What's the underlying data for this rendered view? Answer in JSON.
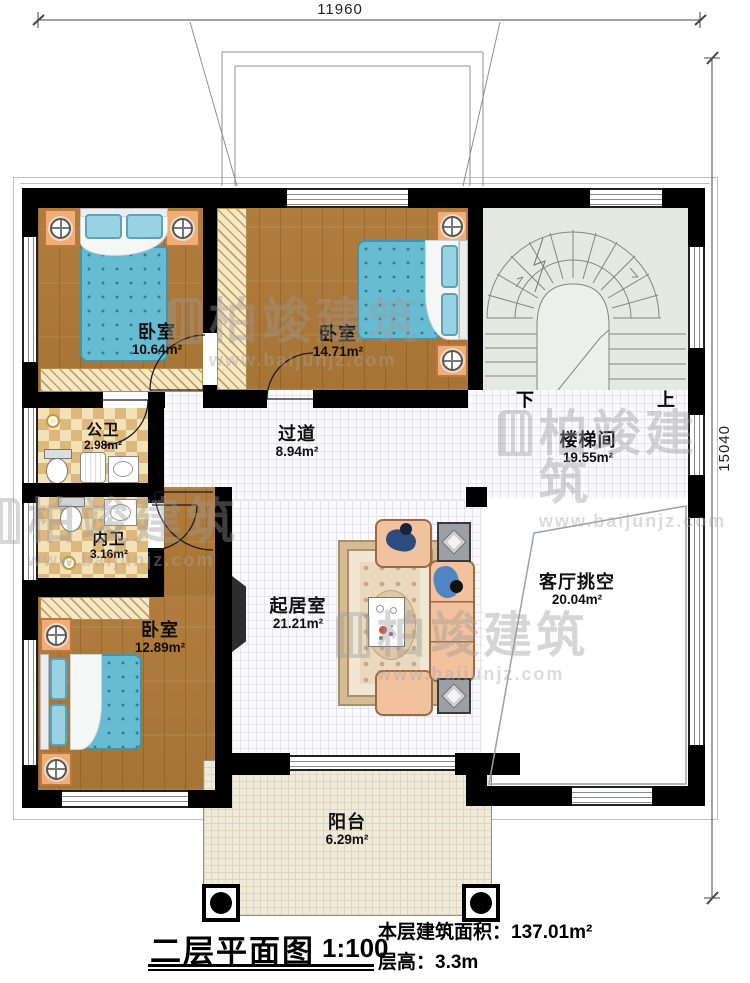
{
  "dimensions": {
    "top": "11960",
    "right": "15040"
  },
  "rooms": [
    {
      "id": "bedroom-top-left",
      "name": "卧室",
      "area": "10.64m²"
    },
    {
      "id": "bedroom-top-middle",
      "name": "卧室",
      "area": "14.71m²"
    },
    {
      "id": "stairwell",
      "name": "楼梯间",
      "area": "19.55m²"
    },
    {
      "id": "public-bath",
      "name": "公卫",
      "area": "2.98m²"
    },
    {
      "id": "corridor",
      "name": "过道",
      "area": "8.94m²"
    },
    {
      "id": "private-bath",
      "name": "内卫",
      "area": "3.16m²"
    },
    {
      "id": "bedroom-bottom-left",
      "name": "卧室",
      "area": "12.89m²"
    },
    {
      "id": "living-room",
      "name": "起居室",
      "area": "21.21m²"
    },
    {
      "id": "living-void",
      "name": "客厅挑空",
      "area": "20.04m²"
    },
    {
      "id": "balcony",
      "name": "阳台",
      "area": "6.29m²"
    }
  ],
  "stairs": {
    "down": "下",
    "up": "上"
  },
  "watermark": {
    "brand": "柏竣建筑",
    "url": "www.baijunjz.com"
  },
  "footer": {
    "title": "二层平面图",
    "scale": "1:100",
    "area_label": "本层建筑面积：",
    "area_value": "137.01m²",
    "height_label": "层高：",
    "height_value": "3.3m"
  },
  "colors": {
    "wall": "#000000",
    "wood_floor": "#ab7838",
    "bath_tile_light": "#f3e2b8",
    "bath_tile_dark": "#dcb87c",
    "stair_floor": "#e5e9e2",
    "balcony_floor": "#efeada",
    "bed_blanket": "#68bcd2",
    "nightstand": "#efae76",
    "sofa": "#f2c19d"
  }
}
